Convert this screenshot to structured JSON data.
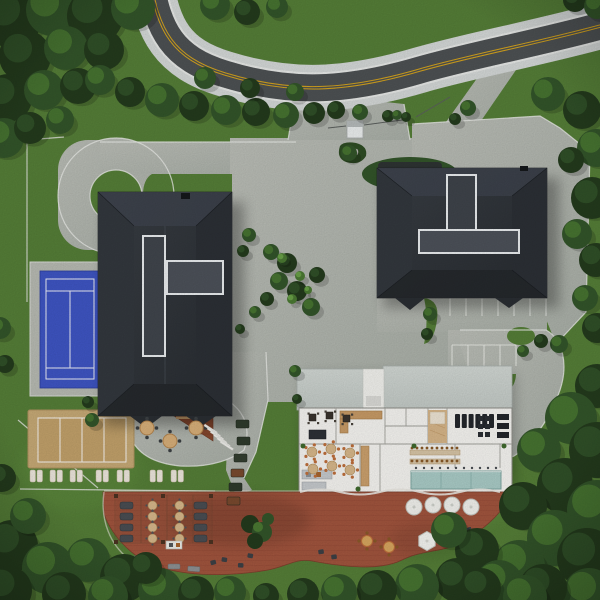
{
  "meta": {
    "description": "Top-down aerial 3D architectural rendering of a residential clubhouse site plan",
    "view": "top-down",
    "canvas": "600x600",
    "visible_text": []
  },
  "palette": {
    "grass": "#567f38",
    "grass_light": "#679944",
    "forest_dark": "#243b1d",
    "forest_mid": "#33552a",
    "canopy_light": "#4b7a33",
    "canopy_highlight": "#6fa84b",
    "road_asphalt": "#4e5254",
    "road_yellow": "#d7a51e",
    "sidewalk": "#d6dad9",
    "paver_light": "#bcbfb8",
    "paver_dark": "#aeb1aa",
    "curb_white": "#ecedea",
    "roof_dark_hi": "#3a3f45",
    "roof_dark_lo": "#2a2e33",
    "roof_trim_white": "#eceff1",
    "roof_light": "#ccd2cd",
    "plan_floor": "#f8f7f3",
    "wall_gray": "#a3a39d",
    "deck_wood": "#a2553e",
    "deck_wood_dark": "#8d4331",
    "patio_wood": "#8a4a30",
    "court_blue": "#3f56c5",
    "sand_tan": "#c8ab77",
    "sand_inner": "#c3a26b",
    "pool_teal": "#abcdc8",
    "furniture_tan": "#d9b98c",
    "accent_orange": "#c0703c",
    "lounger_white": "#efe9df"
  },
  "scene": {
    "site_elements": [
      "curved-two-lane-road-with-double-yellow-line",
      "left-residential-building-dark-roof",
      "right-residential-building-dark-roof",
      "clubhouse-with-exposed-floor-plan",
      "tennis-court-blue",
      "beach-volleyball-court-sand",
      "sun-lounger-rows",
      "circular-driveway-loop",
      "paver-plaza",
      "parking-stalls",
      "landscaped-palm-island",
      "terracotta-wood-deck",
      "pergola-lounge",
      "outdoor-dining-tables",
      "lap-pool-teal",
      "surrounding-forest"
    ]
  },
  "objects": {
    "trees": [
      [
        12,
        18,
        30,
        0
      ],
      [
        52,
        10,
        26,
        1
      ],
      [
        95,
        16,
        28,
        0
      ],
      [
        133,
        8,
        22,
        1
      ],
      [
        25,
        56,
        26,
        0
      ],
      [
        66,
        48,
        22,
        1
      ],
      [
        104,
        50,
        20,
        0
      ],
      [
        8,
        98,
        24,
        0
      ],
      [
        44,
        90,
        20,
        1
      ],
      [
        78,
        86,
        18,
        0
      ],
      [
        4,
        138,
        20,
        1
      ],
      [
        30,
        128,
        16,
        0
      ],
      [
        60,
        120,
        14,
        1
      ],
      [
        100,
        80,
        15,
        1
      ],
      [
        130,
        92,
        15,
        0
      ],
      [
        162,
        100,
        17,
        1
      ],
      [
        194,
        106,
        15,
        0
      ],
      [
        226,
        110,
        15,
        1
      ],
      [
        256,
        112,
        14,
        0
      ],
      [
        286,
        115,
        13,
        1
      ],
      [
        314,
        113,
        11,
        0
      ],
      [
        205,
        78,
        11,
        1
      ],
      [
        250,
        88,
        10,
        0
      ],
      [
        295,
        92,
        9,
        1
      ],
      [
        336,
        110,
        9,
        0
      ],
      [
        360,
        112,
        8,
        1
      ],
      [
        215,
        5,
        15,
        1
      ],
      [
        247,
        12,
        13,
        0
      ],
      [
        277,
        7,
        11,
        1
      ],
      [
        575,
        0,
        12,
        0
      ],
      [
        597,
        6,
        13,
        1
      ],
      [
        548,
        94,
        17,
        1
      ],
      [
        582,
        110,
        19,
        0
      ],
      [
        596,
        148,
        19,
        1
      ],
      [
        571,
        160,
        13,
        0
      ],
      [
        592,
        198,
        21,
        0
      ],
      [
        577,
        234,
        15,
        1
      ],
      [
        596,
        260,
        17,
        0
      ],
      [
        585,
        298,
        13,
        1
      ],
      [
        597,
        328,
        15,
        0
      ],
      [
        388,
        116,
        6,
        0
      ],
      [
        397,
        115,
        5,
        1
      ],
      [
        406,
        117,
        5,
        0
      ],
      [
        349,
        153,
        8,
        1
      ],
      [
        468,
        108,
        8,
        1
      ],
      [
        455,
        119,
        6,
        0
      ],
      [
        271,
        252,
        8,
        1
      ],
      [
        287,
        263,
        10,
        0
      ],
      [
        279,
        281,
        9,
        1
      ],
      [
        297,
        291,
        10,
        0
      ],
      [
        311,
        307,
        9,
        1
      ],
      [
        267,
        299,
        7,
        0
      ],
      [
        317,
        275,
        8,
        0
      ],
      [
        282,
        258,
        5,
        2
      ],
      [
        300,
        276,
        5,
        2
      ],
      [
        292,
        299,
        5,
        2
      ],
      [
        308,
        290,
        4,
        2
      ],
      [
        249,
        235,
        7,
        1
      ],
      [
        243,
        251,
        6,
        0
      ],
      [
        255,
        312,
        6,
        1
      ],
      [
        240,
        329,
        5,
        0
      ],
      [
        559,
        344,
        9,
        1
      ],
      [
        541,
        341,
        7,
        0
      ],
      [
        430,
        314,
        7,
        1
      ],
      [
        427,
        334,
        6,
        0
      ],
      [
        523,
        351,
        6,
        1
      ],
      [
        597,
        386,
        22,
        0
      ],
      [
        571,
        418,
        26,
        1
      ],
      [
        597,
        450,
        28,
        0
      ],
      [
        539,
        450,
        22,
        1
      ],
      [
        565,
        486,
        28,
        0
      ],
      [
        597,
        510,
        30,
        1
      ],
      [
        523,
        506,
        24,
        0
      ],
      [
        555,
        538,
        28,
        1
      ],
      [
        587,
        558,
        30,
        0
      ],
      [
        519,
        566,
        26,
        1
      ],
      [
        477,
        550,
        22,
        0
      ],
      [
        589,
        594,
        26,
        1
      ],
      [
        543,
        588,
        24,
        0
      ],
      [
        499,
        584,
        24,
        1
      ],
      [
        457,
        580,
        22,
        0
      ],
      [
        417,
        586,
        22,
        1
      ],
      [
        377,
        590,
        20,
        0
      ],
      [
        339,
        592,
        18,
        1
      ],
      [
        303,
        594,
        16,
        0
      ],
      [
        449,
        530,
        18,
        1
      ],
      [
        481,
        588,
        20,
        0
      ],
      [
        525,
        597,
        22,
        1
      ],
      [
        12,
        546,
        26,
        0
      ],
      [
        48,
        568,
        26,
        1
      ],
      [
        8,
        590,
        24,
        0
      ],
      [
        88,
        560,
        22,
        1
      ],
      [
        124,
        578,
        24,
        0
      ],
      [
        160,
        590,
        22,
        1
      ],
      [
        196,
        594,
        18,
        0
      ],
      [
        230,
        592,
        16,
        1
      ],
      [
        64,
        594,
        22,
        0
      ],
      [
        108,
        596,
        20,
        1
      ],
      [
        146,
        568,
        16,
        0
      ],
      [
        28,
        516,
        18,
        1
      ],
      [
        2,
        478,
        14,
        0
      ],
      [
        266,
        596,
        13,
        0
      ],
      [
        0,
        328,
        11,
        1
      ],
      [
        5,
        364,
        9,
        0
      ],
      [
        92,
        420,
        7,
        1
      ],
      [
        88,
        402,
        6,
        0
      ],
      [
        295,
        371,
        6,
        1
      ],
      [
        297,
        399,
        5,
        0
      ]
    ],
    "loungers_x": [
      30,
      37,
      50,
      57,
      70,
      77,
      96,
      103,
      117,
      124,
      150,
      157,
      171,
      178
    ],
    "loungers_y": 470,
    "parking": {
      "row1": {
        "x0": 450,
        "step": 16,
        "n": 7,
        "y0": 298,
        "y1": 316,
        "rail_y": 298
      },
      "row2": {
        "x0": 452,
        "step": 16,
        "n": 5,
        "y0": 345,
        "y1": 366,
        "rail_y": 345
      }
    },
    "plan_round_tables": [
      [
        312,
        452
      ],
      [
        331,
        449
      ],
      [
        350,
        453
      ],
      [
        313,
        469
      ],
      [
        332,
        466
      ],
      [
        350,
        470
      ]
    ],
    "plan_square_tables": [
      [
        309,
        414
      ],
      [
        326,
        412
      ],
      [
        343,
        415
      ]
    ],
    "treadmills": {
      "x0": 455,
      "step": 6.8,
      "n": 6,
      "y": 414,
      "w": 5,
      "h": 14
    },
    "gym_squares": [
      [
        478,
        416
      ],
      [
        485,
        416
      ],
      [
        478,
        424
      ],
      [
        485,
        424
      ],
      [
        478,
        432
      ],
      [
        485,
        432
      ]
    ],
    "gym_wide": [
      [
        497,
        414
      ],
      [
        497,
        423
      ],
      [
        497,
        432
      ]
    ],
    "banquet_chair_rows": {
      "x0": 412,
      "step": 5,
      "n": 10,
      "y_rows": [
        448,
        461
      ]
    },
    "pool_chairs": {
      "x0": 416,
      "step": 8,
      "n": 11,
      "y": 468
    },
    "pergola_rows_y": [
      502,
      513,
      524,
      535
    ],
    "deck_white_tables": [
      [
        414,
        507
      ],
      [
        433,
        505
      ],
      [
        452,
        505
      ],
      [
        471,
        507
      ]
    ],
    "deck_orange_tables": [
      [
        367,
        541
      ],
      [
        389,
        547
      ]
    ],
    "deck_dark_seats": [
      [
        90,
        549
      ],
      [
        101,
        552
      ],
      [
        210,
        561
      ],
      [
        222,
        557
      ],
      [
        248,
        553
      ],
      [
        318,
        550
      ],
      [
        331,
        555
      ],
      [
        238,
        563
      ]
    ],
    "deck_gray_loungers": [
      [
        128,
        557,
        -8
      ],
      [
        146,
        561,
        -4
      ],
      [
        168,
        564,
        0
      ],
      [
        188,
        566,
        4
      ]
    ],
    "patio_tables": [
      [
        147,
        428
      ],
      [
        170,
        441
      ],
      [
        196,
        428
      ]
    ],
    "stairs": {
      "x0": 205,
      "y0": 424,
      "dx": 3.2,
      "dy": 3.3,
      "n": 6,
      "w": 15,
      "h": 2.2,
      "angle": 33
    },
    "bench_column": [
      [
        236,
        420,
        "#2f3b2c"
      ],
      [
        237,
        437,
        "#2f3b2c"
      ],
      [
        234,
        454,
        "#343f31"
      ],
      [
        231,
        469,
        "#7a4a2e"
      ],
      [
        229,
        483,
        "#2f3b2c"
      ],
      [
        227,
        497,
        "#7a4a2e"
      ]
    ]
  }
}
